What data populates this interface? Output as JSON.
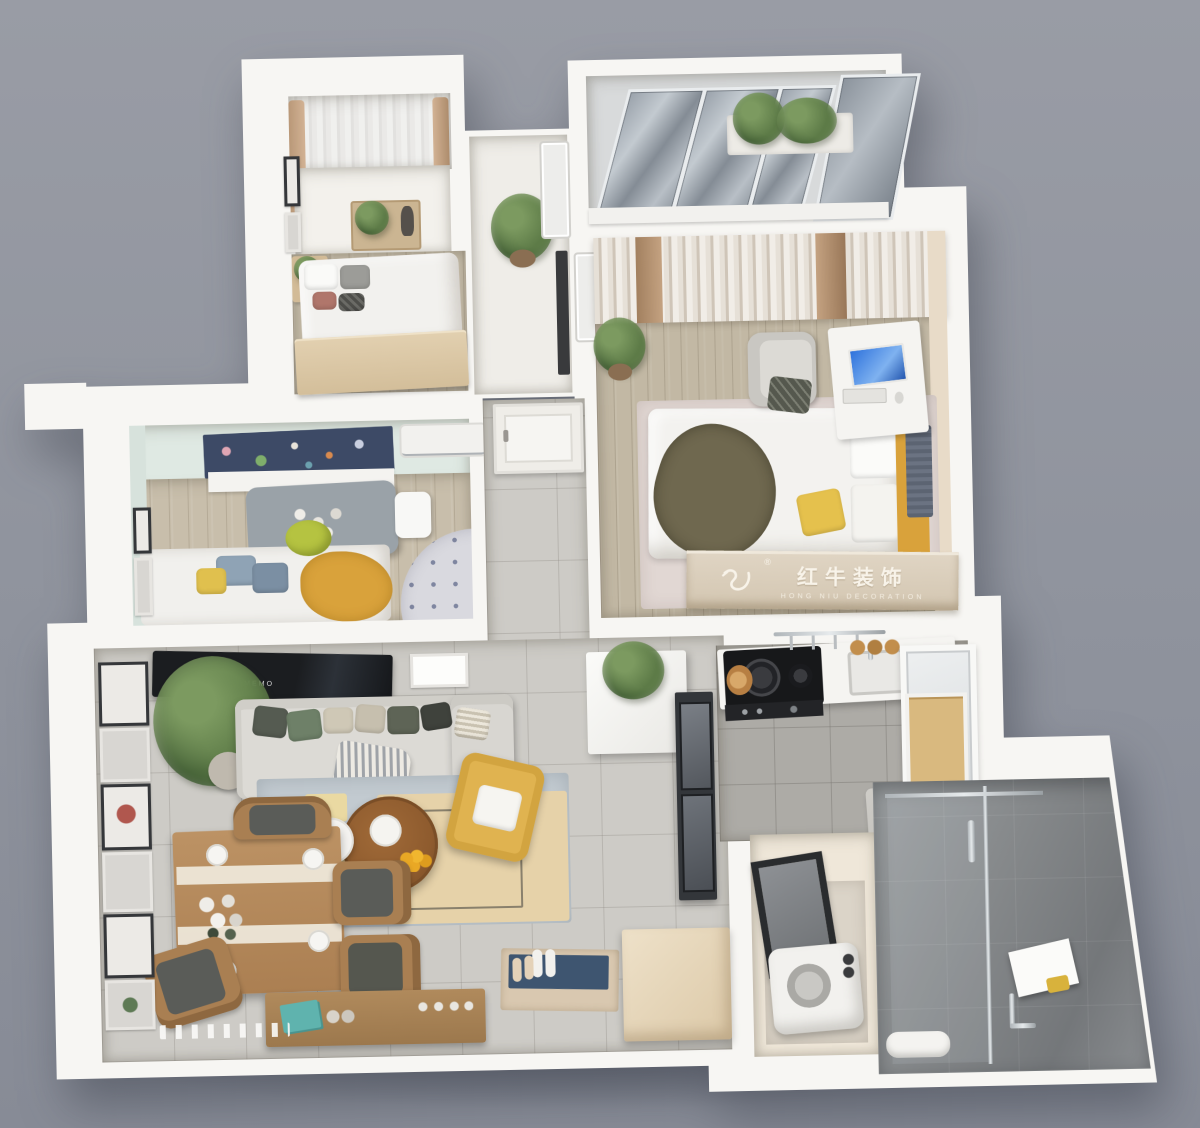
{
  "image": {
    "kind": "3d-apartment-floorplan-render",
    "view": "top-down dollhouse cutaway",
    "background_color": "#8F939D"
  },
  "watermark": {
    "registered_mark": "®",
    "brand_cn": "红牛装饰",
    "brand_en": "HONG NIU DECORATION",
    "logo_icon": "bull-swoosh-icon",
    "text_color": "#F8F3E9",
    "band_color": "#D9CDBB"
  },
  "living_room": {
    "tv_screen_label": "MEMO"
  },
  "palette": {
    "background": "#8F939D",
    "plate_white": "#F7F6F3",
    "wood_floor": "#C8BEAB",
    "gray_tile": "#CDCBC6",
    "kitchen_tile": "#ADABA6",
    "mint_wall": "#DFE9E3",
    "master_wall_tan": "#E8DBC8",
    "accent_yellow": "#E0B350",
    "accent_mustard": "#D9A23B",
    "accent_olive": "#6F684F",
    "accent_green": "#6E8068",
    "navy_mat": "#3E5570",
    "space_blind_navy": "#3D4A66",
    "bath_tile": "#8E9294",
    "tv_black": "#1B1D20",
    "dining_wood": "#B5895C",
    "coffee_table_wood": "#8E5B2E"
  },
  "rooms": [
    {
      "id": "bedroom-2",
      "label": "Second Bedroom",
      "position": "top-left",
      "features": [
        "bay window with sheer curtains",
        "marble sill with plant tray",
        "double bed with wood footboard",
        "nightstand",
        "wall frames"
      ]
    },
    {
      "id": "glass-balcony",
      "label": "Enclosed Glass Balcony",
      "position": "top-right",
      "features": [
        "sloped glazing panels",
        "planter with shrubs"
      ]
    },
    {
      "id": "master-bedroom",
      "label": "Master Bedroom",
      "position": "right-middle",
      "features": [
        "striped curtain wall",
        "bed with olive throw and yellow pillow",
        "branded headboard",
        "desk with monitor",
        "lounge chair",
        "rug",
        "potted plant",
        "air conditioner"
      ]
    },
    {
      "id": "kids-room",
      "label": "Kids Room",
      "position": "left-middle",
      "features": [
        "space-print roller blind",
        "wall AC unit",
        "gray play table with blocks",
        "white chair",
        "bed with mustard blanket",
        "polka-dot round rug",
        "wall frames"
      ]
    },
    {
      "id": "hallway",
      "label": "Entry Hallway",
      "position": "center",
      "features": [
        "white entrance door",
        "gray tiled floor"
      ]
    },
    {
      "id": "living-dining",
      "label": "Living / Dining Room",
      "position": "bottom-left",
      "features": [
        "wall TV",
        "fabric sofa with cushions",
        "monstera plant",
        "layered rug",
        "round wood coffee table",
        "white side table",
        "yellow armchair",
        "dining table with place settings",
        "wood chairs",
        "gallery wall",
        "wood sideboard",
        "entry mat with shoes",
        "shoe cabinet",
        "white console with plant",
        "dark display cabinet"
      ]
    },
    {
      "id": "kitchen",
      "label": "Kitchen",
      "position": "right-middle-lower",
      "features": [
        "black cooktop with wok",
        "white counter with sink",
        "hanging utensil rail",
        "wood jars",
        "window",
        "open wood shelf",
        "gray under-window appliance"
      ]
    },
    {
      "id": "laundry",
      "label": "Utility / Laundry Room",
      "position": "bottom-center-right",
      "features": [
        "dark framed window",
        "washing machine"
      ]
    },
    {
      "id": "bathroom",
      "label": "Bathroom",
      "position": "bottom-right",
      "features": [
        "glass shower enclosure",
        "stone tile walls",
        "white mirror",
        "chrome faucet",
        "amenities"
      ]
    }
  ]
}
